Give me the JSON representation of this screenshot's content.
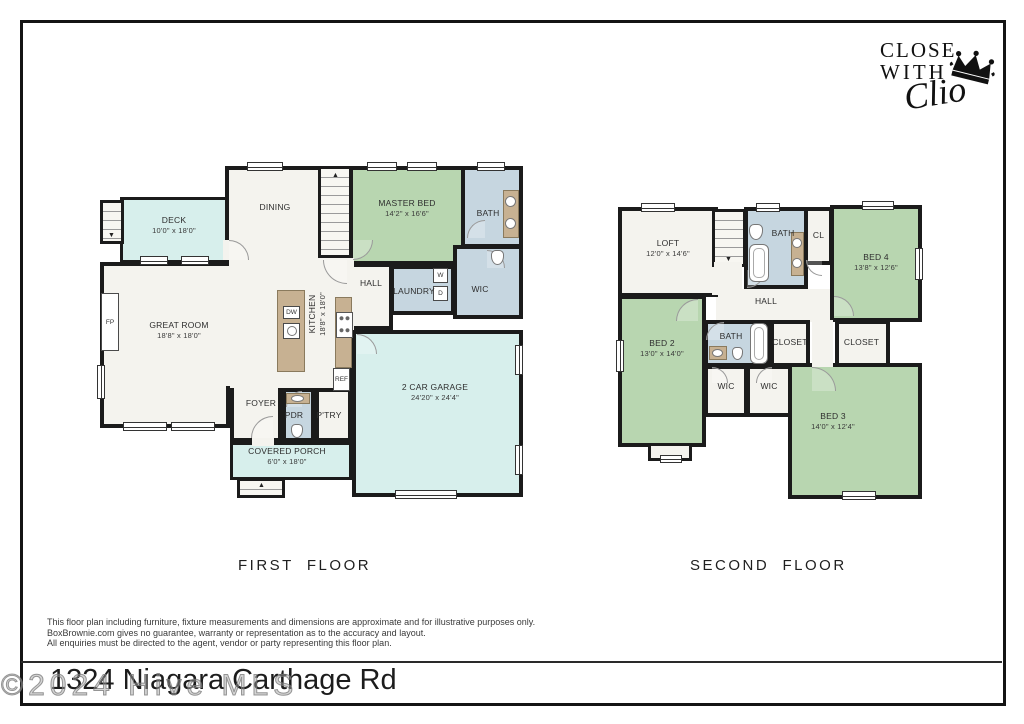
{
  "logo": {
    "line1": "CLOSE",
    "line2": "WITH",
    "script": "Clio"
  },
  "ff": {
    "title": "FIRST  FLOOR",
    "deck": {
      "name": "DECK",
      "dims": "10'0\" x 18'0\""
    },
    "dining": {
      "name": "DINING"
    },
    "master": {
      "name": "MASTER BED",
      "dims": "14'2\" x 16'6\""
    },
    "bath": {
      "name": "BATH"
    },
    "wic": {
      "name": "WIC"
    },
    "hall": {
      "name": "HALL"
    },
    "laundry": {
      "name": "LAUNDRY"
    },
    "washer": "W",
    "dryer": "D",
    "great": {
      "name": "GREAT ROOM",
      "dims": "18'8\" x 18'0\""
    },
    "kitchen": {
      "name": "KITCHEN",
      "dims": "18'8\" x 18'0\""
    },
    "fp": "FP",
    "dw": "DW",
    "ref": "REF",
    "foyer": {
      "name": "FOYER"
    },
    "pdr": {
      "name": "PDR"
    },
    "pantry": {
      "name": "P'TRY"
    },
    "porch": {
      "name": "COVERED PORCH",
      "dims": "6'0\" x 18'0\""
    },
    "garage": {
      "name": "2 CAR GARAGE",
      "dims": "24'20\" x 24'4\""
    }
  },
  "sf": {
    "title": "SECOND  FLOOR",
    "loft": {
      "name": "LOFT",
      "dims": "12'0\" x 14'6\""
    },
    "bath": {
      "name": "BATH"
    },
    "cl": {
      "name": "CL"
    },
    "bed4": {
      "name": "BED 4",
      "dims": "13'8\" x 12'6\""
    },
    "hall": {
      "name": "HALL"
    },
    "bed2": {
      "name": "BED 2",
      "dims": "13'0\" x 14'0\""
    },
    "bath2": {
      "name": "BATH"
    },
    "closet_l": "CLOSET",
    "closet_r": "CLOSET",
    "wic_l": "WIC",
    "wic_r": "WIC",
    "bed3": {
      "name": "BED 3",
      "dims": "14'0\" x 12'4\""
    }
  },
  "disclaimer": {
    "line1": "This floor plan including furniture, fixture measurements and dimensions are approximate and for illustrative purposes only.",
    "line2": "BoxBrownie.com gives no guarantee, warranty or representation as to the accuracy and layout.",
    "line3": "All enquiries must be directed to the agent, vendor or party representing this floor plan."
  },
  "address": "1324 Niagara Carthage Rd",
  "watermark": "©2024 Hive MLS",
  "colors": {
    "bedroom_green": "#b8d6b0",
    "wet_room_blue": "#c6d6e0",
    "outdoor_cyan": "#d7efec",
    "cabinet_tan": "#c7b192",
    "wall": "#1b1b1b"
  }
}
